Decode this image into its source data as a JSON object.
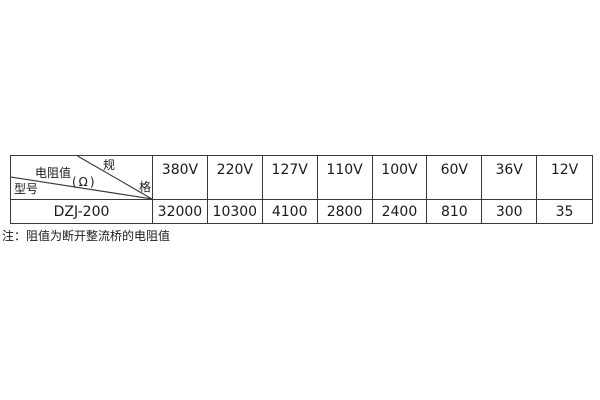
{
  "table": {
    "corner": {
      "spec_top": "规",
      "spec_bottom": "格",
      "resistance_label": "电阻值",
      "resistance_unit": "(Ω)",
      "model_label": "型号"
    },
    "columns": [
      "380V",
      "220V",
      "127V",
      "110V",
      "100V",
      "60V",
      "36V",
      "12V"
    ],
    "rows": [
      {
        "model": "DZJ-200",
        "values": [
          "32000",
          "10300",
          "4100",
          "2800",
          "2400",
          "810",
          "300",
          "35"
        ]
      }
    ]
  },
  "note": "注：阻值为断开整流桥的电阻值",
  "colors": {
    "border": "#3a3a3a",
    "text": "#1a1a1a",
    "bg": "#ffffff"
  }
}
